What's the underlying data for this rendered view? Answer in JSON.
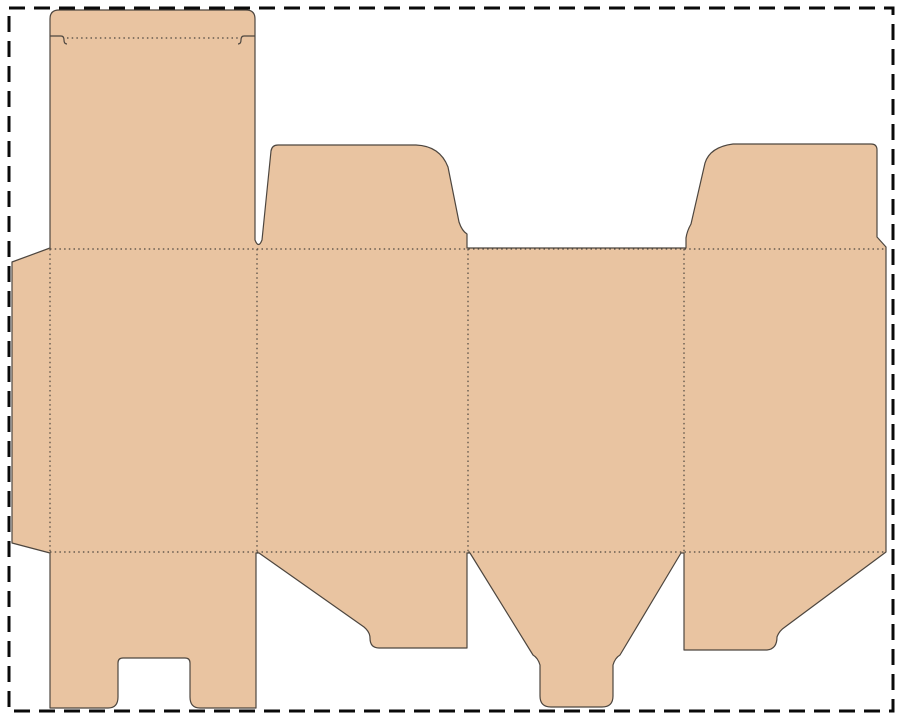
{
  "meta": {
    "title": "Box die-cut template",
    "canvas_width": 900,
    "canvas_height": 719
  },
  "colors": {
    "background": "#ffffff",
    "cardboard_fill": "#e9c4a1",
    "cut_line": "#4d463f",
    "fold_line": "#4d463f",
    "border_line": "#0a0a0a"
  },
  "svg": {
    "view_box": "0 0 900 719",
    "border": {
      "name": "dashed-cut-border",
      "x": 9,
      "y": 8,
      "width": 884,
      "height": 703,
      "stroke_width": 3,
      "dash_pattern": "16 9"
    },
    "silhouette": {
      "name": "box-dieline-silhouette",
      "stroke_width": 1.2,
      "path": "M 50 19 Q 50 10 59 10 L 246 10 Q 255 10 255 19 L 255 240 Q 258.5 249 262 240 L 271 151 Q 272 145 278 145 L 416 145 Q 440 146 448 167 L 459 222 Q 462 231 467 234 L 467 248 L 686 248 L 686 238 Q 687 231 691 224 L 705 163 Q 710 147 733 144 L 871 144 Q 877 144 877 150 L 877 237 L 886 247 L 886 552 L 785 627 Q 779 631 777 637 Q 777 649 767 650 L 684 650 L 684 553 L 681 553 L 620 655 Q 615 658 613 665 L 613 696 Q 613 707 602 707 L 551 707 Q 540 707 540 696 L 540 665 Q 538 658 533 655 L 470 553 L 467 553 L 467 648 L 379 648 Q 370 648 370 638 Q 370 632 364 627 L 259 553 L 256 553 L 256 708 L 200 708 Q 190 708 190 697 L 190 663 Q 190 658 185 658 L 123 658 Q 118 658 118 663 L 118 697 Q 118 708 108 708 L 50 708 L 50 553 L 12 543 L 12 262 L 50 248 Z"
    },
    "fold_lines": {
      "stroke_width": 1.2,
      "dash_pattern": "1.5 3.2",
      "items": [
        {
          "name": "fold-tuck-flap",
          "d": "M 67 38 L 238 38"
        },
        {
          "name": "fold-band-top",
          "d": "M 50 249 L 886 249"
        },
        {
          "name": "fold-band-bottom",
          "d": "M 50 552 L 886 552"
        },
        {
          "name": "fold-glue-flap",
          "d": "M 50 249 L 50 552"
        },
        {
          "name": "fold-panel-1-2",
          "d": "M 257 249 L 257 552"
        },
        {
          "name": "fold-panel-2-3",
          "d": "M 468 249 L 468 552"
        },
        {
          "name": "fold-panel-3-4",
          "d": "M 684 249 L 684 552"
        }
      ]
    },
    "cut_details": {
      "stroke_width": 1.2,
      "items": [
        {
          "name": "tuck-slit-left",
          "d": "M 50 36 L 61 36 Q 64 36 64 40 Q 64 44 67 44"
        },
        {
          "name": "tuck-slit-right",
          "d": "M 255 36 L 244 36 Q 241 36 241 40 Q 241 44 238 44"
        }
      ]
    }
  }
}
